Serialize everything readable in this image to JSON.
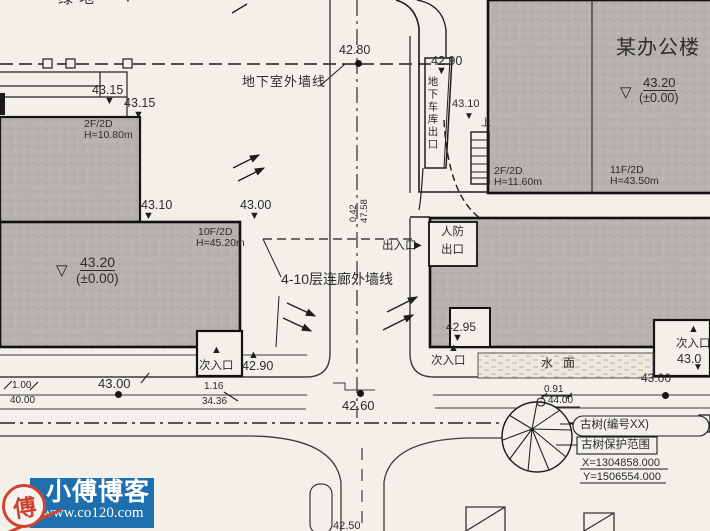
{
  "colors": {
    "paper": "#f2f0e9",
    "building_gray": "#b6b3ae",
    "line": "#1d1d1d",
    "watermark_blue": "#1e6fae",
    "seal_red": "#cf4430"
  },
  "watermark": {
    "blog_name": "小傅博客",
    "url": "www.co120.com",
    "seal_char": "傅"
  },
  "annotations": [
    {
      "name": "green-area-label",
      "text": "绿地",
      "x": 58,
      "y": -9,
      "fs": 15,
      "ls": 6
    },
    {
      "name": "elev-43-15-a",
      "text": "43.15",
      "x": 92,
      "y": 84,
      "fs": 12.5
    },
    {
      "name": "elev-43-15-b",
      "text": "43.15",
      "x": 124,
      "y": 97,
      "fs": 12.5
    },
    {
      "name": "bldg-a-floors",
      "text": "2F/2D",
      "x": 84,
      "y": 119,
      "fs": 10.5
    },
    {
      "name": "bldg-a-height",
      "text": "H=10.80m",
      "x": 84,
      "y": 130,
      "fs": 10.5
    },
    {
      "name": "elev-43-10-a",
      "text": "43.10",
      "x": 141,
      "y": 199,
      "fs": 12.5
    },
    {
      "name": "elev-43-00-a",
      "text": "43.00",
      "x": 240,
      "y": 199,
      "fs": 12.5
    },
    {
      "name": "bldg-b-floors",
      "text": "10F/2D",
      "x": 198,
      "y": 227,
      "fs": 10.5
    },
    {
      "name": "bldg-b-height",
      "text": "H=45.20m",
      "x": 196,
      "y": 238,
      "fs": 10.5
    },
    {
      "name": "level-43-20-left",
      "text": "43.20",
      "x": 80,
      "y": 255,
      "fs": 14,
      "cls": "u"
    },
    {
      "name": "level-pm000-left",
      "text": "(±0.00)",
      "x": 76,
      "y": 272,
      "fs": 13.5
    },
    {
      "name": "elev-42-80",
      "text": "42.80",
      "x": 339,
      "y": 44,
      "fs": 12.5
    },
    {
      "name": "basement-wall-label",
      "text": "地下室外墙线",
      "x": 242,
      "y": 75,
      "fs": 13,
      "ls": 1
    },
    {
      "name": "elev-42-90-top",
      "text": "42.90",
      "x": 431,
      "y": 55,
      "fs": 12.5
    },
    {
      "name": "elev-43-10-garage",
      "text": "43.10",
      "x": 452,
      "y": 99,
      "fs": 11
    },
    {
      "name": "up-label",
      "text": "上",
      "x": 481,
      "y": 119,
      "fs": 10
    },
    {
      "name": "garage-exit-label",
      "text": "地下车库出口",
      "x": 427,
      "y": 76,
      "fs": 10.5,
      "cls": "vert"
    },
    {
      "name": "office-building-name",
      "text": "某办公楼",
      "x": 616,
      "y": 38,
      "fs": 20,
      "ls": 1
    },
    {
      "name": "level-43-20-right",
      "text": "43.20",
      "x": 643,
      "y": 76,
      "fs": 13,
      "cls": "u"
    },
    {
      "name": "level-pm000-right",
      "text": "(±0.00)",
      "x": 639,
      "y": 92,
      "fs": 12.5
    },
    {
      "name": "annex-floors",
      "text": "2F/2D",
      "x": 494,
      "y": 166,
      "fs": 10.5
    },
    {
      "name": "annex-height",
      "text": "H=11.60m",
      "x": 494,
      "y": 177,
      "fs": 10.5
    },
    {
      "name": "bldg-r-floors",
      "text": "11F/2D",
      "x": 610,
      "y": 165,
      "fs": 10.5
    },
    {
      "name": "bldg-r-height",
      "text": "H=43.50m",
      "x": 610,
      "y": 176,
      "fs": 10.5
    },
    {
      "name": "entrance-exit-label",
      "text": "出入口",
      "x": 382,
      "y": 241,
      "fs": 11.5
    },
    {
      "name": "civil-defense-line1",
      "text": "人防",
      "x": 441,
      "y": 227,
      "fs": 11.5
    },
    {
      "name": "civil-defense-line2",
      "text": "出口",
      "x": 441,
      "y": 245,
      "fs": 11.5
    },
    {
      "name": "corridor-wall-label",
      "text": "4-10层连廊外墙线",
      "x": 281,
      "y": 272,
      "fs": 14
    },
    {
      "name": "dim-0-42",
      "text": "0.42",
      "x": 349,
      "y": 222,
      "fs": 9,
      "rot": -90
    },
    {
      "name": "dim-47-58",
      "text": "47.58",
      "x": 360,
      "y": 223,
      "fs": 9.5,
      "rot": -90
    },
    {
      "name": "elev-42-95",
      "text": "42.95",
      "x": 446,
      "y": 321,
      "fs": 12
    },
    {
      "name": "entrance-center-label",
      "text": "次入口",
      "x": 431,
      "y": 356,
      "fs": 11.5
    },
    {
      "name": "water-surface-label",
      "text": "水面",
      "x": 541,
      "y": 357,
      "fs": 12,
      "ls": 10
    },
    {
      "name": "entrance-right-label",
      "text": "次入口",
      "x": 676,
      "y": 339,
      "fs": 11.5
    },
    {
      "name": "elev-43-0-right",
      "text": "43.0",
      "x": 677,
      "y": 353,
      "fs": 12.5
    },
    {
      "name": "entrance-left-label",
      "text": "次入口",
      "x": 199,
      "y": 361,
      "fs": 11.5
    },
    {
      "name": "elev-42-90-bottom",
      "text": "42.90",
      "x": 242,
      "y": 360,
      "fs": 12.5
    },
    {
      "name": "dim-1-00",
      "text": "1.00",
      "x": 12,
      "y": 381,
      "fs": 10
    },
    {
      "name": "dim-40-00",
      "text": "40.00",
      "x": 10,
      "y": 396,
      "fs": 10
    },
    {
      "name": "elev-43-00-road",
      "text": "43.00",
      "x": 98,
      "y": 377,
      "fs": 13
    },
    {
      "name": "dim-1-16",
      "text": "1.16",
      "x": 204,
      "y": 382,
      "fs": 10
    },
    {
      "name": "dim-34-36",
      "text": "34.36",
      "x": 202,
      "y": 397,
      "fs": 10
    },
    {
      "name": "elev-42-60",
      "text": "42.60",
      "x": 342,
      "y": 399,
      "fs": 13
    },
    {
      "name": "dim-0-91",
      "text": "0.91",
      "x": 544,
      "y": 385,
      "fs": 10
    },
    {
      "name": "dim-44-00",
      "text": "44.00",
      "x": 548,
      "y": 396,
      "fs": 10
    },
    {
      "name": "elev-43-00-right",
      "text": "43.00",
      "x": 641,
      "y": 372,
      "fs": 12
    },
    {
      "name": "ancient-tree-label",
      "text": "古树(编号XX)",
      "x": 580,
      "y": 420,
      "fs": 11.5
    },
    {
      "name": "tree-protect-label",
      "text": "古树保护范围",
      "x": 581,
      "y": 440,
      "fs": 11.5
    },
    {
      "name": "coord-x",
      "text": "X=1304858.000",
      "x": 582,
      "y": 458,
      "fs": 11
    },
    {
      "name": "coord-y",
      "text": "Y=1506554.000",
      "x": 583,
      "y": 472,
      "fs": 11
    },
    {
      "name": "elev-42-50",
      "text": "42.50",
      "x": 333,
      "y": 521,
      "fs": 11
    }
  ],
  "markers": [
    {
      "name": "level-marker",
      "glyph": "▼",
      "x": 122,
      "y": -8,
      "fs": 12
    },
    {
      "name": "level-marker",
      "glyph": "▼",
      "x": 104,
      "y": 96,
      "fs": 11
    },
    {
      "name": "level-marker",
      "glyph": "▼",
      "x": 133,
      "y": 110,
      "fs": 11
    },
    {
      "name": "level-marker",
      "glyph": "▼",
      "x": 143,
      "y": 211,
      "fs": 11
    },
    {
      "name": "level-marker",
      "glyph": "▼",
      "x": 249,
      "y": 211,
      "fs": 11
    },
    {
      "name": "level-symbol",
      "glyph": "▽",
      "x": 56,
      "y": 263,
      "fs": 15
    },
    {
      "name": "level-marker",
      "glyph": "▼",
      "x": 436,
      "y": 66,
      "fs": 11
    },
    {
      "name": "level-marker",
      "glyph": "▼",
      "x": 464,
      "y": 112,
      "fs": 10
    },
    {
      "name": "level-symbol",
      "glyph": "▽",
      "x": 620,
      "y": 85,
      "fs": 15
    },
    {
      "name": "entrance-arrow",
      "glyph": "▶",
      "x": 414,
      "y": 241,
      "fs": 10
    },
    {
      "name": "level-marker",
      "glyph": "▼",
      "x": 452,
      "y": 333,
      "fs": 11
    },
    {
      "name": "entrance-marker",
      "glyph": "▲",
      "x": 448,
      "y": 343,
      "fs": 11
    },
    {
      "name": "entrance-marker",
      "glyph": "▲",
      "x": 211,
      "y": 345,
      "fs": 11
    },
    {
      "name": "entrance-marker",
      "glyph": "▲",
      "x": 248,
      "y": 350,
      "fs": 11
    },
    {
      "name": "entrance-marker",
      "glyph": "▲",
      "x": 688,
      "y": 324,
      "fs": 11
    },
    {
      "name": "level-marker",
      "glyph": "▼",
      "x": 693,
      "y": 363,
      "fs": 10
    }
  ],
  "dots": [
    {
      "name": "elevation-dot",
      "x": 355,
      "y": 60
    },
    {
      "name": "elevation-dot",
      "x": 115,
      "y": 391
    },
    {
      "name": "elevation-dot",
      "x": 357,
      "y": 390
    },
    {
      "name": "elevation-dot",
      "x": 662,
      "y": 392
    }
  ]
}
